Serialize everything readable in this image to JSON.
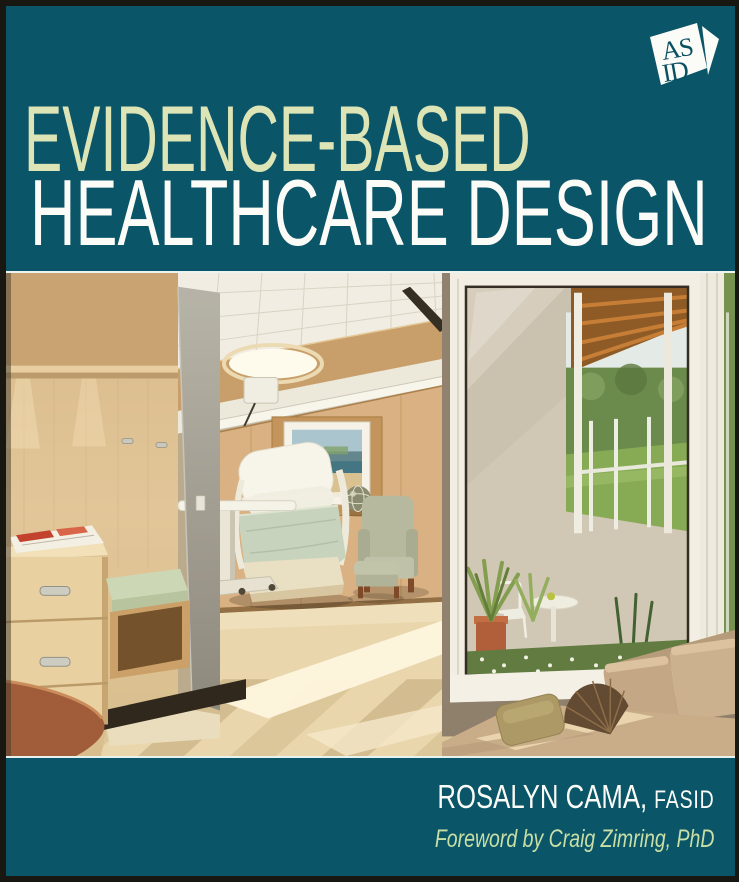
{
  "cover": {
    "publisher_logo": {
      "name": "ASID",
      "letters_top": "AS",
      "letters_bottom": "ID"
    },
    "title": {
      "line1": "EVIDENCE-BASED",
      "line2": "HEALTHCARE DESIGN"
    },
    "credits": {
      "author_name": "ROSALYN CAMA,",
      "author_credential": "FASID",
      "foreword": "Foreword by Craig Zimring, PhD"
    },
    "colors": {
      "teal_background": "#0b5568",
      "title_line1": "#dde4b5",
      "title_line2": "#fbfcf8",
      "foreword_text": "#c8dfa6",
      "outer_border": "#191712",
      "photo_divider": "#eef4f0",
      "logo_white": "#fbfcf7",
      "logo_letters": "#0b4f63"
    },
    "photo_alt": "Daylit patient room with light wood paneling, a reclining patient chair with sage-green blanket, overbed table, framed coastal artwork, sage armchair with ottoman, built-in window-seat bench and drawers, and a large corner window above a tan daybed looking out to a planted terrace and green lawn."
  }
}
